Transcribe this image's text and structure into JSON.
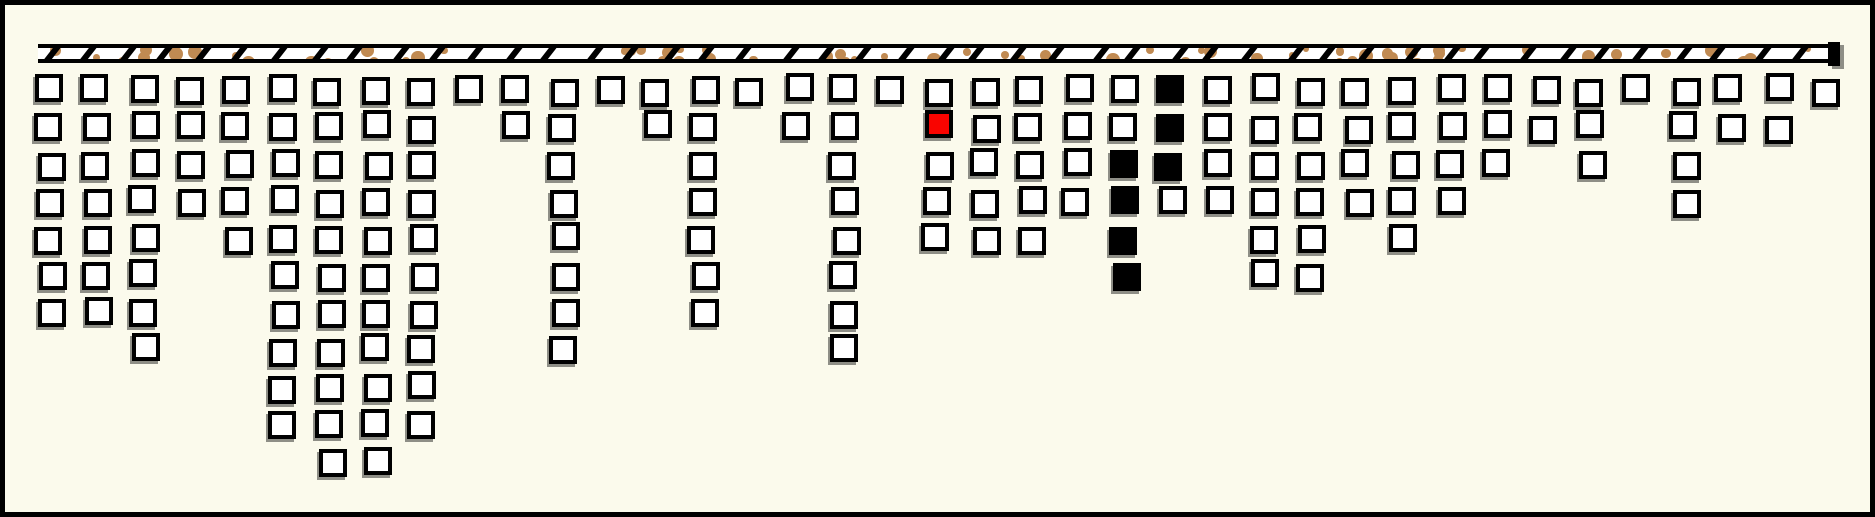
{
  "colors": {
    "background": "#FBFAEC",
    "outline": "#000000",
    "square_fill": "#FFFFFF",
    "bar_fill": "#FFFFFF",
    "red": "#F90400",
    "black": "#000000",
    "speckle": "#C08A52",
    "shadow": "#8E8E86"
  },
  "chart_data": {
    "type": "bar",
    "style": "unit-square columns hanging from a hatched ceiling bar",
    "n_columns": 39,
    "max_units": 11,
    "values": [
      7,
      7,
      8,
      4,
      5,
      10,
      11,
      11,
      10,
      1,
      2,
      8,
      1,
      2,
      7,
      1,
      2,
      8,
      1,
      5,
      5,
      5,
      4,
      6,
      4,
      4,
      6,
      6,
      4,
      5,
      4,
      3,
      2,
      3,
      1,
      4,
      2,
      2,
      1
    ],
    "special_cells": [
      {
        "column": 20,
        "row": 2,
        "color": "red"
      },
      {
        "column": 24,
        "row": 3,
        "color": "black"
      },
      {
        "column": 24,
        "row": 4,
        "color": "black"
      },
      {
        "column": 24,
        "row": 5,
        "color": "black"
      },
      {
        "column": 24,
        "row": 6,
        "color": "black"
      },
      {
        "column": 25,
        "row": 1,
        "color": "black"
      },
      {
        "column": 25,
        "row": 2,
        "color": "black"
      },
      {
        "column": 25,
        "row": 3,
        "color": "black"
      }
    ],
    "total_squares": 182,
    "title": "",
    "xlabel": "",
    "ylabel": "",
    "legend": "none",
    "grid": "off",
    "orientation": "columns grow downward from top support bar",
    "ceiling_decoration": {
      "hatch_marks": "black diagonal slashes",
      "speckles": "tan dots"
    }
  }
}
